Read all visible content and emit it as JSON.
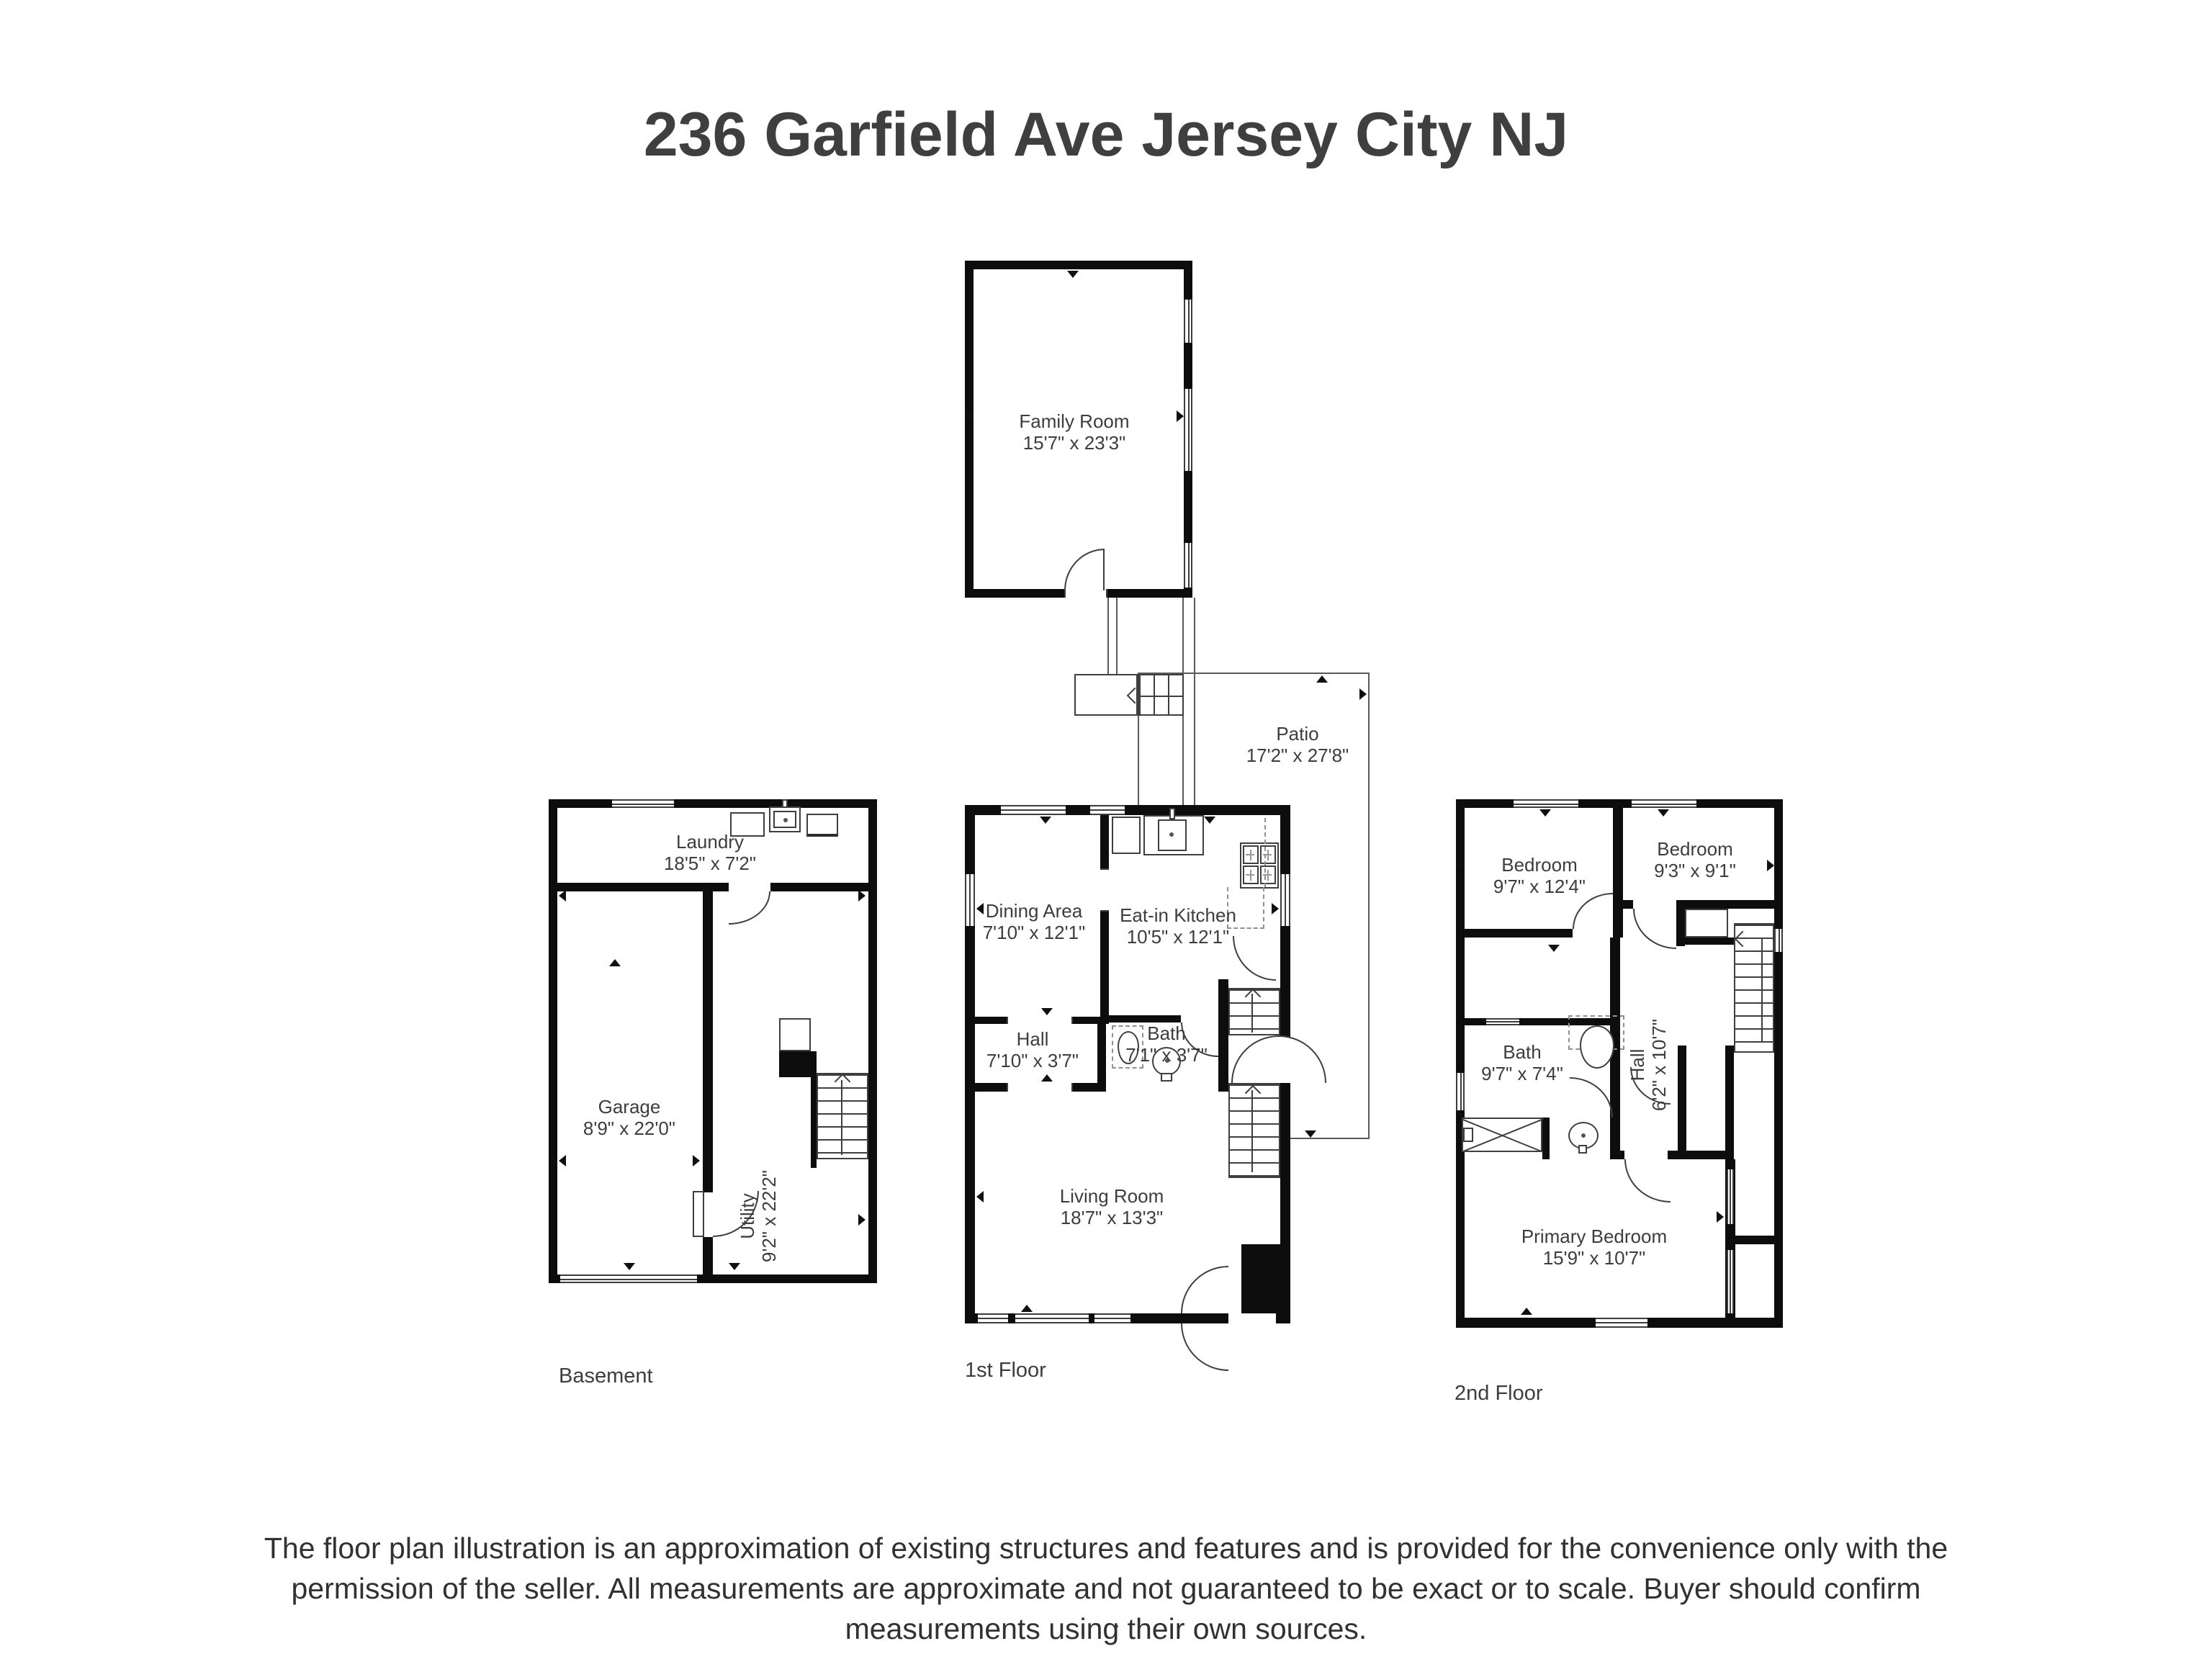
{
  "title": "236 Garfield Ave Jersey City NJ",
  "plans": {
    "family_room": {
      "room": {
        "name": "Family Room",
        "dims": "15'7\" x 23'3\""
      }
    },
    "patio": {
      "room": {
        "name": "Patio",
        "dims": "17'2\" x 27'8\""
      }
    },
    "basement": {
      "label": "Basement",
      "rooms": {
        "laundry": {
          "name": "Laundry",
          "dims": "18'5\" x 7'2\""
        },
        "garage": {
          "name": "Garage",
          "dims": "8'9\" x 22'0\""
        },
        "utility": {
          "name": "Utility",
          "dims": "9'2\" x 22'2\""
        }
      }
    },
    "first_floor": {
      "label": "1st Floor",
      "rooms": {
        "dining": {
          "name": "Dining Area",
          "dims": "7'10\" x 12'1\""
        },
        "kitchen": {
          "name": "Eat-in Kitchen",
          "dims": "10'5\" x 12'1\""
        },
        "hall": {
          "name": "Hall",
          "dims": "7'10\" x 3'7\""
        },
        "bath": {
          "name": "Bath",
          "dims": "7'1\" x 3'7\""
        },
        "living": {
          "name": "Living Room",
          "dims": "18'7\" x 13'3\""
        }
      }
    },
    "second_floor": {
      "label": "2nd Floor",
      "rooms": {
        "bedroom_left": {
          "name": "Bedroom",
          "dims": "9'7\" x 12'4\""
        },
        "bedroom_right": {
          "name": "Bedroom",
          "dims": "9'3\" x 9'1\""
        },
        "bath": {
          "name": "Bath",
          "dims": "9'7\" x 7'4\""
        },
        "hall": {
          "name": "Hall",
          "dims": "6'2\" x 10'7\""
        },
        "primary": {
          "name": "Primary Bedroom",
          "dims": "15'9\" x 10'7\""
        }
      }
    }
  },
  "disclaimer": {
    "line1": "The floor plan illustration is an approximation of existing structures and features and is provided for the convenience only with the",
    "line2": "permission of the seller. All measurements are approximate and not guaranteed to be exact or to scale. Buyer should confirm",
    "line3": "measurements using their own sources.",
    "footnote": "."
  }
}
